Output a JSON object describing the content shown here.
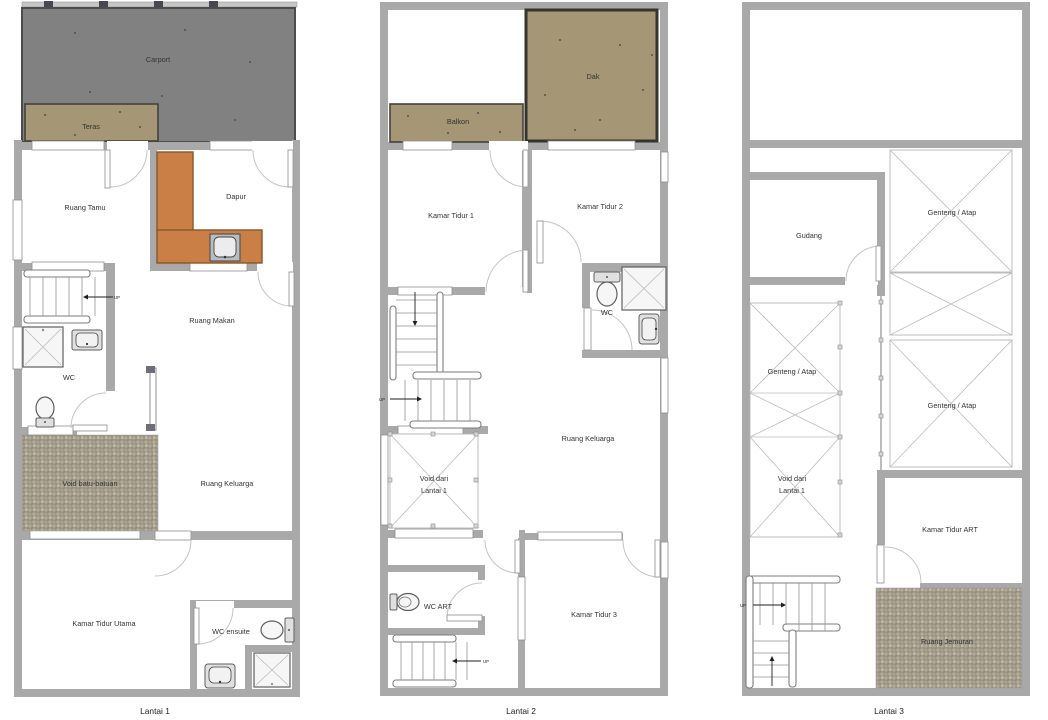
{
  "palette": {
    "wall": "#a9a9a9",
    "carport_fill": "#818181",
    "carport_border": "#4d4d4d",
    "deck_fill": "#a59675",
    "deck_border": "#35342e",
    "counter_fill": "#c97f45",
    "counter_border": "#8a5526",
    "pebble_light": "#b7b09f",
    "pebble_dark": "#958e7d",
    "line": "#b6b6b6",
    "text": "#333333"
  },
  "labels": {
    "up": "UP",
    "floor1": {
      "title": "Lantai 1",
      "carport": "Carport",
      "teras": "Teras",
      "ruang_tamu": "Ruang Tamu",
      "dapur": "Dapur",
      "ruang_makan": "Ruang Makan",
      "wc": "WC",
      "void_batu": "Void batu-batuan",
      "ruang_keluarga": "Ruang Keluarga",
      "kamar_tidur_utama": "Kamar Tidur Utama",
      "wc_ensuite": "WC ensuite"
    },
    "floor2": {
      "title": "Lantai 2",
      "balkon": "Balkon",
      "dak": "Dak",
      "kamar_tidur_1": "Kamar Tidur 1",
      "kamar_tidur_2": "Kamar Tidur 2",
      "wc": "WC",
      "ruang_keluarga": "Ruang Keluarga",
      "void_line1": "Void dari",
      "void_line2": "Lantai 1",
      "wc_art": "WC ART",
      "kamar_tidur_3": "Kamar Tidur 3"
    },
    "floor3": {
      "title": "Lantai 3",
      "gudang": "Gudang",
      "genteng_atap": "Genteng / Atap",
      "void_line1": "Void dari",
      "void_line2": "Lantai 1",
      "kamar_tidur_art": "Kamar Tidur ART",
      "ruang_jemuran": "Ruang Jemuran"
    }
  }
}
